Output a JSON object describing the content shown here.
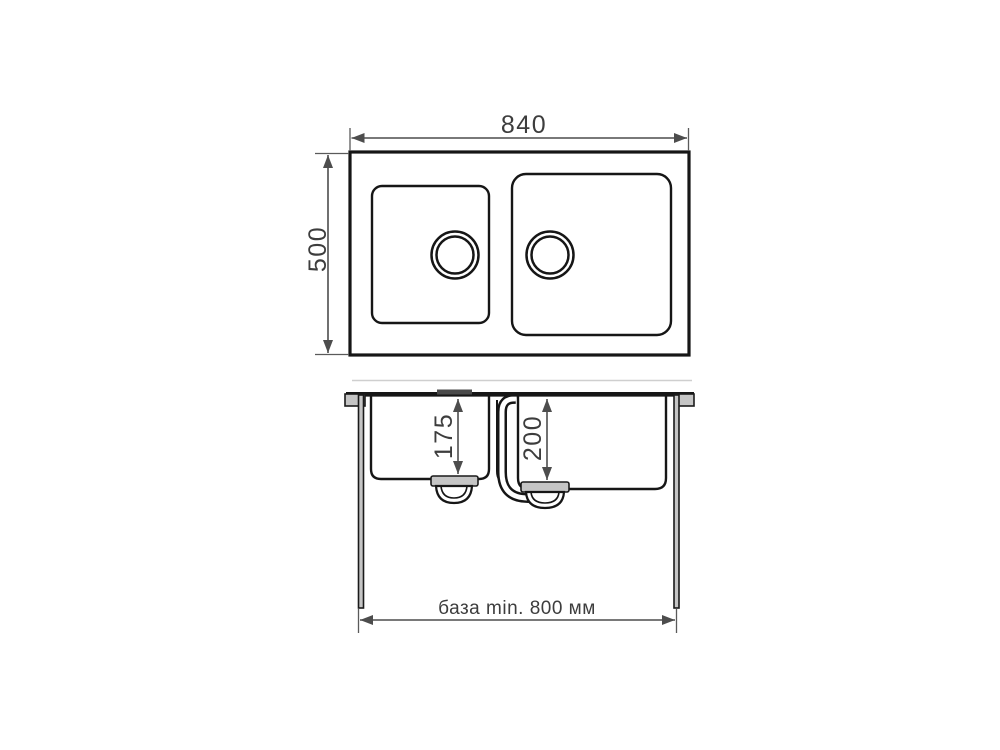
{
  "diagram": {
    "top_view": {
      "width_label": "840",
      "height_label": "500"
    },
    "section_view": {
      "left_bowl_depth_label": "175",
      "right_bowl_depth_label": "200",
      "cabinet_base_label": "база min. 800 мм"
    },
    "colors": {
      "line": "#161616",
      "dimension": "#4d4d4d",
      "label_text": "#3d3d3d",
      "gray_fill": "#c5c5c5",
      "background": "#ffffff"
    }
  }
}
